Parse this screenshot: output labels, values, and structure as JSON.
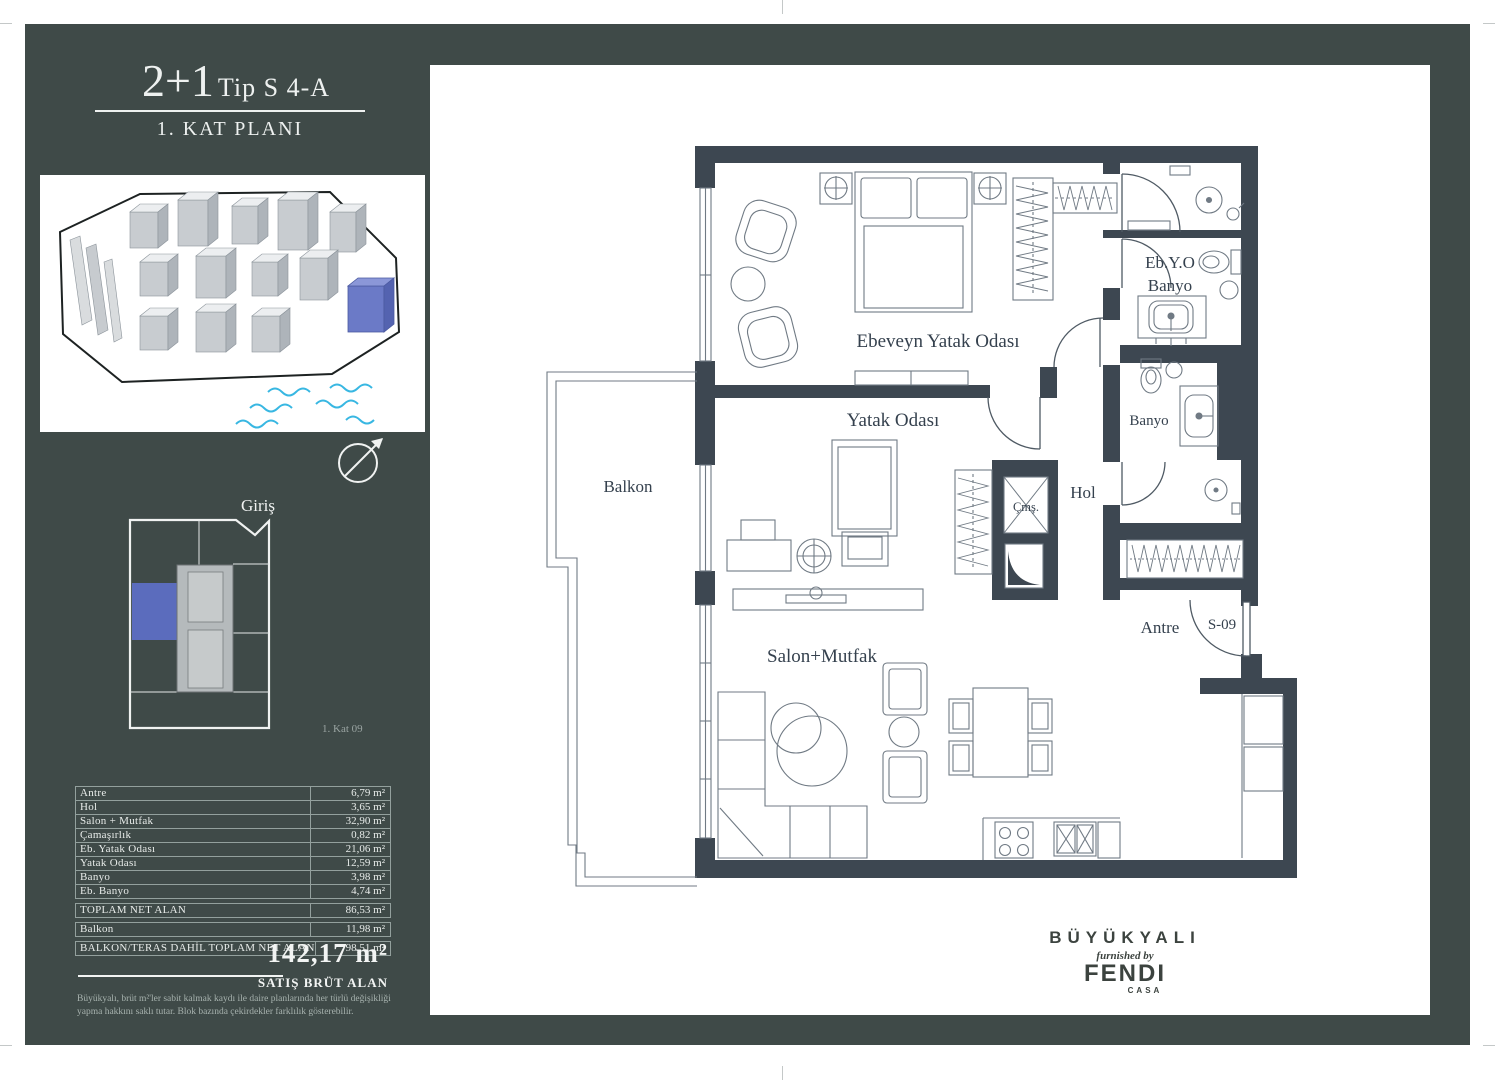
{
  "title": {
    "size": "2+1",
    "type": "Tip S 4-A",
    "floor": "1. KAT PLANI"
  },
  "sidebar": {
    "entrance_label": "Giriş",
    "floor_unit_label": "1. Kat 09",
    "areas": [
      {
        "label": "Antre",
        "value": "6,79 m²"
      },
      {
        "label": "Hol",
        "value": "3,65 m²"
      },
      {
        "label": "Salon + Mutfak",
        "value": "32,90 m²"
      },
      {
        "label": "Çamaşırlık",
        "value": "0,82 m²"
      },
      {
        "label": "Eb. Yatak Odası",
        "value": "21,06 m²"
      },
      {
        "label": "Yatak Odası",
        "value": "12,59 m²"
      },
      {
        "label": "Banyo",
        "value": "3,98 m²"
      },
      {
        "label": "Eb. Banyo",
        "value": "4,74 m²"
      }
    ],
    "totals": [
      {
        "label": "TOPLAM NET ALAN",
        "value": "86,53 m²"
      },
      {
        "label": "Balkon",
        "value": "11,98 m²"
      },
      {
        "label": "BALKON/TERAS DAHİL TOPLAM NET ALAN",
        "value": "98,51 m²"
      }
    ],
    "gross_area_value": "142,17 m²",
    "gross_area_label": "SATIŞ BRÜT ALAN",
    "disclaimer_line1": "Büyükyalı, brüt m²'ler sabit kalmak kaydı ile daire planlarında her türlü değişikliği",
    "disclaimer_line2": "yapma hakkını saklı tutar. Blok bazında çekirdekler farklılık gösterebilir."
  },
  "plan": {
    "room_labels": {
      "balkon": "Balkon",
      "master_bedroom": "Ebeveyn Yatak Odası",
      "bedroom": "Yatak Odası",
      "master_bath_line1": "Eb.Y.O",
      "master_bath_line2": "Banyo",
      "bathroom": "Banyo",
      "hall": "Hol",
      "laundry": "Çmş.",
      "entry": "Antre",
      "unit_no": "S-09",
      "living": "Salon+Mutfak"
    }
  },
  "brand": {
    "name": "BÜYÜKYALI",
    "tagline": "furnished by",
    "designer": "FENDI",
    "collection": "CASA"
  },
  "colors": {
    "panel": "#3f4a48",
    "wall": "#3d4751",
    "accent_blue": "#5b6cbd",
    "water": "#38b7e2"
  }
}
